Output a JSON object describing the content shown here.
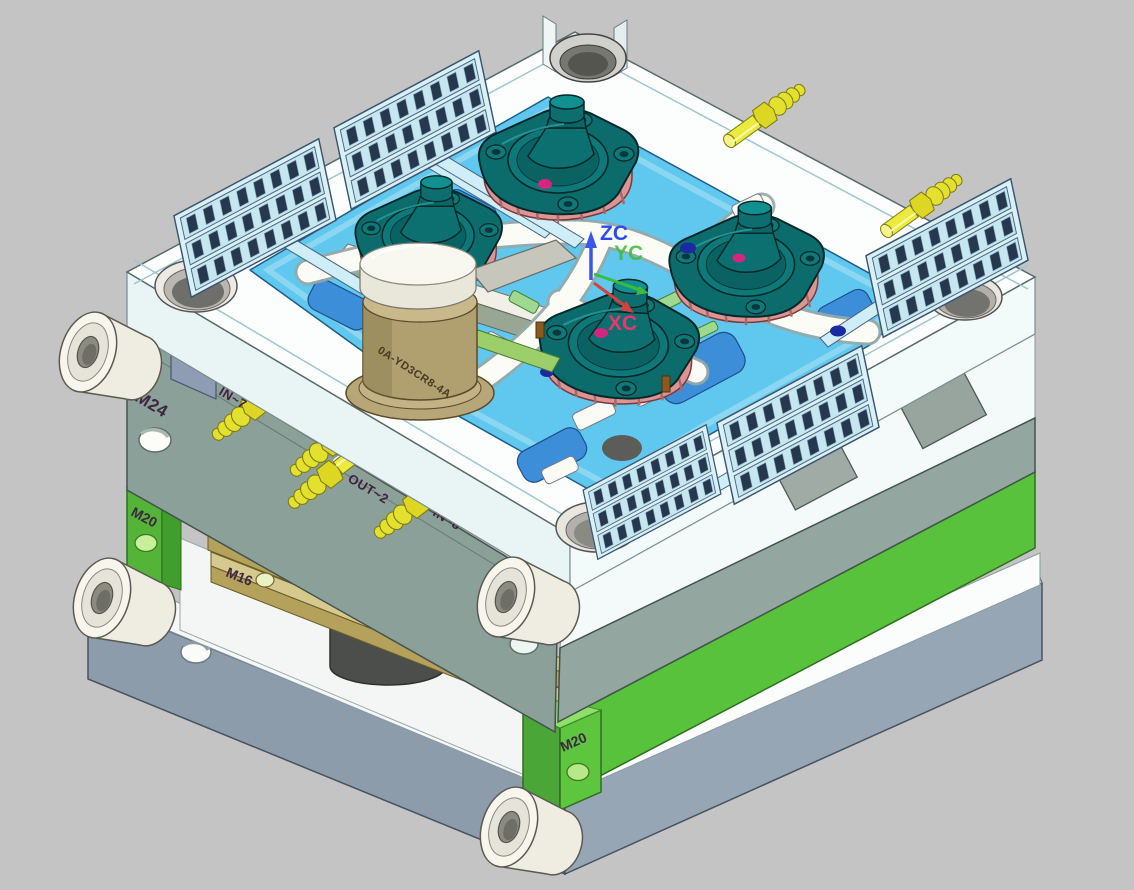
{
  "viewport": {
    "description": "3D CAD isometric view of a plastic injection mold assembly with four molded gearbox covers",
    "background": "#c4c4c4"
  },
  "wcs": {
    "z": {
      "label": "ZC",
      "color": "#2b4bf0"
    },
    "y": {
      "label": "YC",
      "color": "#3dbb3d"
    },
    "x": {
      "label": "XC",
      "color": "#e8386a"
    }
  },
  "markings": {
    "m24_left": "M24",
    "m24_front": "M24",
    "m20_support_left": "M20",
    "m20_support_front": "M20",
    "m20_base": "M20",
    "m16_bar_upper": "M16",
    "m16_bar_lower": "M16"
  },
  "coolant_fittings": {
    "in7": {
      "label": "IN~7"
    },
    "in2": {
      "label": "IN~2"
    },
    "out2": {
      "label": "OUT~2"
    },
    "in8": {
      "label": "IN~8"
    }
  },
  "sprue_bushing": {
    "marking": "0A-YD3CR8-4A"
  },
  "palette": {
    "mold_plate_gray": "#8fa29a",
    "support_plate_green": "#58c23c",
    "cavity_blue": "#60c8ee",
    "molded_part_teal": "#0c6c6c",
    "core_pink": "#dd9595",
    "fitting_yellow": "#e8e428",
    "base_plate_gray": "#8d9cab",
    "runner_white": "#fdfdfa",
    "sprue_tan": "#b4a376"
  }
}
